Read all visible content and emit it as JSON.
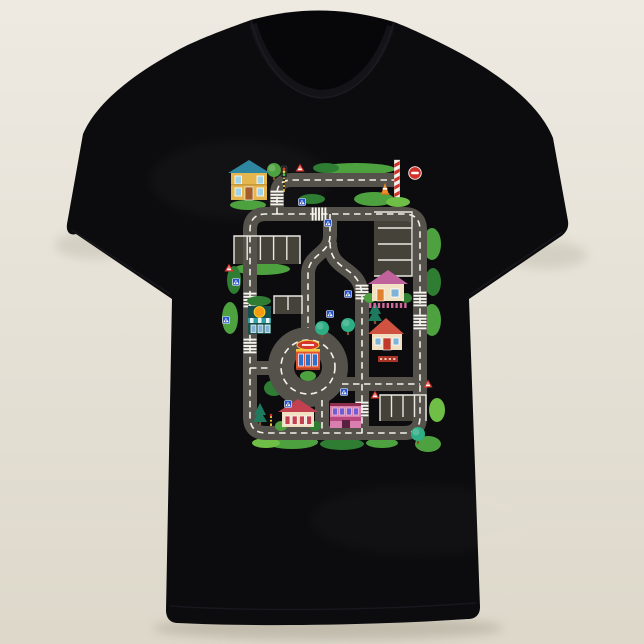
{
  "scene": {
    "background_top": "#eeeae2",
    "background_bottom": "#ddd8ca",
    "shadow_color": "#aaa494",
    "shirt": {
      "fill": "#0c0c0e",
      "collar_band": "#141418",
      "inner_neck": "#07070a",
      "seam": "#1d1d23"
    }
  },
  "playmat": {
    "colors": {
      "road": "#55524b",
      "road_line": "#f2f1ea",
      "pad": "#454239",
      "pad_line": "#e9e7e0",
      "green_mid": "#4da23f",
      "green_light": "#6fbe45",
      "green_dark": "#2e7d33",
      "green_teal": "#2fae85",
      "pine": "#1e7a5f",
      "trunk": "#80522a",
      "sign_blue": "#2653cf",
      "sign_red": "#d23129",
      "white": "#f6f5f0",
      "cone_orange": "#f28c28",
      "pole_yellow": "#e8c23a"
    },
    "road_width": 14,
    "dash_pattern": "6.5 4.5",
    "roads": [
      {
        "name": "top-road-and-entry",
        "d": "M176,28 H70 Q55,28 55,42 V62"
      },
      {
        "name": "outer-ring-road",
        "d": "M55,62 H182 Q198,62 198,78 V265 Q198,281 182,281 H44 Q28,281 28,265 V78 Q28,62 44,62 H55"
      },
      {
        "name": "center-s-road",
        "d": "M108,62 V84 C108,102 86,102 86,122 V176"
      },
      {
        "name": "east-branch-road",
        "d": "M108,90 C108,122 140,112 140,146 V281"
      },
      {
        "name": "southeast-road",
        "d": "M120,232 H198"
      },
      {
        "name": "roundabout-west-spur",
        "d": "M28,216 H50"
      },
      {
        "name": "roundabout-south-spur",
        "d": "M100,248 V281"
      }
    ],
    "roundabout": {
      "cx": 86,
      "cy": 215,
      "ring_radius": 27,
      "ring_width": 26,
      "island_radius": 13
    },
    "zebras": [
      {
        "x": 55,
        "y": 46,
        "dir": "v"
      },
      {
        "x": 97,
        "y": 62,
        "dir": "h"
      },
      {
        "x": 28,
        "y": 148,
        "dir": "v"
      },
      {
        "x": 28,
        "y": 194,
        "dir": "v"
      },
      {
        "x": 198,
        "y": 147,
        "dir": "v"
      },
      {
        "x": 198,
        "y": 170,
        "dir": "v"
      },
      {
        "x": 140,
        "y": 140,
        "dir": "v"
      },
      {
        "x": 140,
        "y": 257,
        "dir": "v"
      }
    ],
    "parkings": [
      {
        "name": "parking-left",
        "x": 12,
        "y": 84,
        "w": 66,
        "h": 28,
        "dividers": "v",
        "n": 4
      },
      {
        "name": "parking-right",
        "x": 152,
        "y": 60,
        "w": 38,
        "h": 64,
        "dividers": "h",
        "n": 3
      },
      {
        "name": "parking-small-mid",
        "x": 52,
        "y": 144,
        "w": 28,
        "h": 18,
        "dividers": "v",
        "n": 1
      },
      {
        "name": "parking-bottom-right",
        "x": 158,
        "y": 243,
        "w": 46,
        "h": 26,
        "dividers": "v",
        "n": 3
      }
    ],
    "buildings": [
      {
        "type": "two_story",
        "name": "blue-roof-house",
        "x": 8,
        "y": 8,
        "roof": "#2f86a0",
        "wall": "#e5b54e",
        "window": "#9fd3e8",
        "door": "#a35c2a"
      },
      {
        "type": "cottage_pink",
        "name": "pink-roof-cottage",
        "x": 148,
        "y": 118,
        "roof": "#c0629b",
        "wall": "#f2e2c4",
        "door": "#e0812f",
        "window": "#7fb3d8",
        "fence": "#d06a9e"
      },
      {
        "type": "house_red",
        "name": "red-roof-house",
        "x": 148,
        "y": 166,
        "roof": "#cf5340",
        "wall": "#f0dfc0",
        "door": "#c0392b",
        "window": "#7fb3d8",
        "banner": "#a93226"
      },
      {
        "type": "fire_station",
        "name": "roundabout-station",
        "x": 74,
        "y": 190,
        "wall": "#e05530",
        "trim": "#f5c842",
        "window": "#2e6fd0",
        "sign": "#d6352b"
      },
      {
        "type": "shop_orange",
        "name": "orange-sign-shop",
        "x": 26,
        "y": 150,
        "wall": "#17504a",
        "disc": "#f39c12",
        "awning": "#2ea0a8",
        "window": "#7fb3d8"
      },
      {
        "type": "cottage_red",
        "name": "red-roof-cottage",
        "x": 58,
        "y": 247,
        "roof": "#c2404f",
        "wall": "#f0dfc0",
        "window": "#c2404f"
      },
      {
        "type": "shop_pink",
        "name": "pink-shop",
        "x": 108,
        "y": 245,
        "wall": "#d87fb0",
        "roofline": "#8c2f4f",
        "window": "#6e5fd0",
        "awning": "#b8487f",
        "door": "#5a2040"
      }
    ],
    "trees": [
      {
        "x": 52,
        "y": 18,
        "kind": "round"
      },
      {
        "x": 100,
        "y": 176,
        "kind": "teal"
      },
      {
        "x": 126,
        "y": 173,
        "kind": "teal"
      },
      {
        "x": 153,
        "y": 161,
        "kind": "pine"
      },
      {
        "x": 38,
        "y": 262,
        "kind": "pine"
      },
      {
        "x": 196,
        "y": 282,
        "kind": "teal"
      }
    ],
    "bushes": [
      {
        "x": 134,
        "y": 17,
        "rx": 39,
        "ry": 6,
        "c": "green_mid"
      },
      {
        "x": 104,
        "y": 16,
        "rx": 13,
        "ry": 5,
        "c": "green_dark"
      },
      {
        "x": 26,
        "y": 53,
        "rx": 18,
        "ry": 5,
        "c": "green_mid"
      },
      {
        "x": 90,
        "y": 47,
        "rx": 13,
        "ry": 5,
        "c": "green_dark"
      },
      {
        "x": 152,
        "y": 47,
        "rx": 20,
        "ry": 7,
        "c": "green_mid"
      },
      {
        "x": 176,
        "y": 50,
        "rx": 12,
        "ry": 5,
        "c": "green_light"
      },
      {
        "x": 40,
        "y": 117,
        "rx": 28,
        "ry": 6,
        "c": "green_mid"
      },
      {
        "x": 12,
        "y": 128,
        "rx": 7,
        "ry": 14,
        "c": "green_dark"
      },
      {
        "x": 8,
        "y": 166,
        "rx": 8,
        "ry": 16,
        "c": "green_mid"
      },
      {
        "x": 210,
        "y": 92,
        "rx": 9,
        "ry": 16,
        "c": "green_mid"
      },
      {
        "x": 211,
        "y": 130,
        "rx": 8,
        "ry": 14,
        "c": "green_dark"
      },
      {
        "x": 210,
        "y": 168,
        "rx": 9,
        "ry": 16,
        "c": "green_mid"
      },
      {
        "x": 52,
        "y": 236,
        "rx": 10,
        "ry": 8,
        "c": "green_dark"
      },
      {
        "x": 70,
        "y": 290,
        "rx": 26,
        "ry": 7,
        "c": "green_mid"
      },
      {
        "x": 120,
        "y": 292,
        "rx": 22,
        "ry": 6,
        "c": "green_dark"
      },
      {
        "x": 160,
        "y": 291,
        "rx": 16,
        "ry": 5,
        "c": "green_mid"
      },
      {
        "x": 44,
        "y": 291,
        "rx": 14,
        "ry": 5,
        "c": "green_light"
      },
      {
        "x": 206,
        "y": 292,
        "rx": 13,
        "ry": 8,
        "c": "green_mid"
      },
      {
        "x": 215,
        "y": 258,
        "rx": 8,
        "ry": 12,
        "c": "green_light"
      }
    ],
    "signs": [
      {
        "type": "blue_cross",
        "x": 80,
        "y": 50
      },
      {
        "type": "blue_cross",
        "x": 106,
        "y": 71
      },
      {
        "type": "blue_cross",
        "x": 14,
        "y": 130
      },
      {
        "type": "blue_cross",
        "x": 4,
        "y": 168
      },
      {
        "type": "blue_cross",
        "x": 108,
        "y": 162
      },
      {
        "type": "blue_cross",
        "x": 122,
        "y": 240
      },
      {
        "type": "blue_cross",
        "x": 66,
        "y": 252
      },
      {
        "type": "blue_cross",
        "x": 126,
        "y": 142
      },
      {
        "type": "warn_triangle",
        "x": 78,
        "y": 16
      },
      {
        "type": "warn_triangle",
        "x": 7,
        "y": 116
      },
      {
        "type": "warn_triangle",
        "x": 206,
        "y": 232
      },
      {
        "type": "warn_triangle",
        "x": 153,
        "y": 243
      },
      {
        "type": "no_entry",
        "x": 193,
        "y": 21
      },
      {
        "type": "striped_pole",
        "x": 175,
        "y": 8
      },
      {
        "type": "cone",
        "x": 163,
        "y": 38
      },
      {
        "type": "traffic_light",
        "x": 62,
        "y": 30
      },
      {
        "type": "mini_pole",
        "x": 49,
        "y": 271
      }
    ]
  }
}
